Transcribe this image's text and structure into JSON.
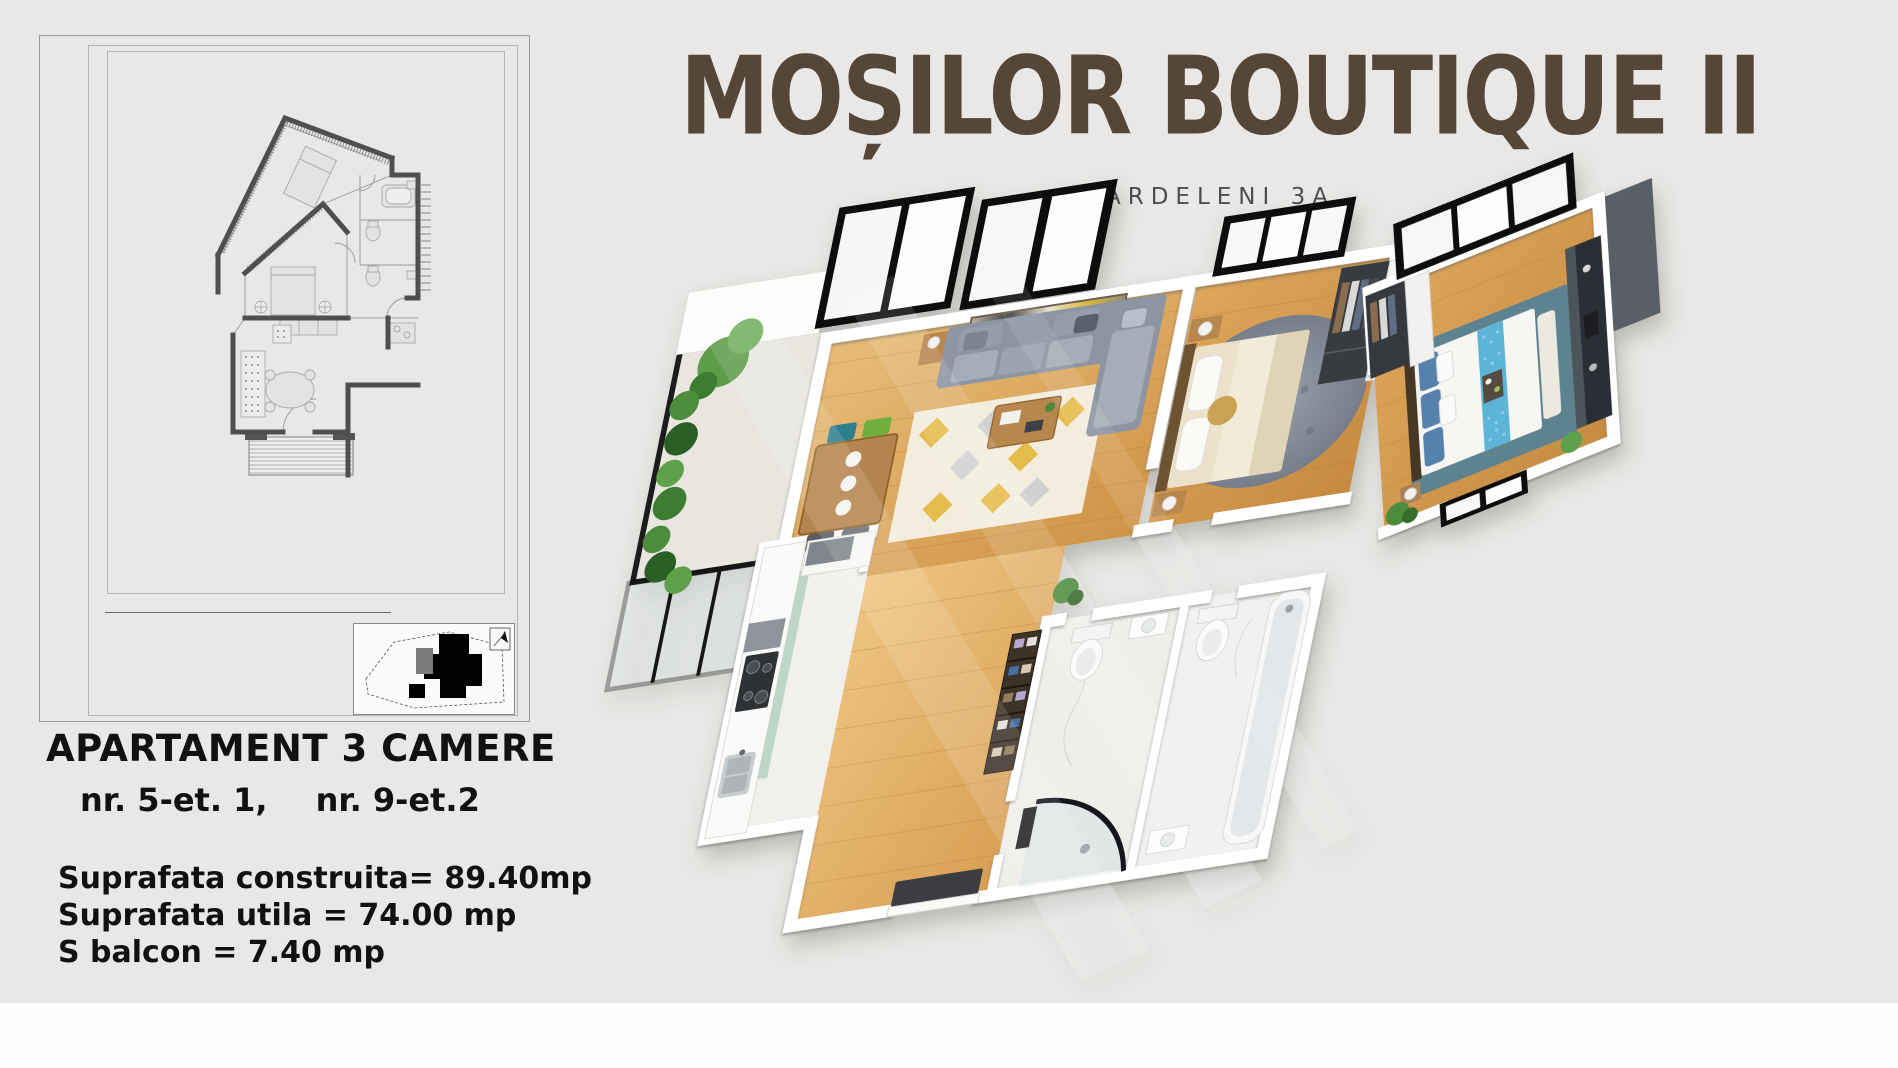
{
  "project": {
    "title": "MOȘILOR BOUTIQUE II",
    "subtitle": "ARDELENI 3A",
    "title_color": "#554637"
  },
  "apartment": {
    "title": "APARTAMENT 3 CAMERE",
    "unit_left": "nr. 5-et. 1,",
    "unit_right": "nr. 9-et.2",
    "areas": [
      "Suprafata construita= 89.40mp",
      "Suprafata utila = 74.00 mp",
      "S balcon = 7.40 mp"
    ]
  },
  "site_plan": {
    "north_icon": "north-arrow"
  },
  "palette": {
    "canvas_bg": "#e9e8e6",
    "footer_bg": "#fdfdfc",
    "text_black": "#111111",
    "title_brown": "#554637",
    "subtitle_gray": "#4e4e4e",
    "plan_wall_gray": "#4f4f4f",
    "wood_floor": "#dda75e",
    "wall_white": "#ffffff",
    "window_black": "#131313",
    "sofa_gray": "#9aa1ad",
    "rug_yellow": "#e4b63c",
    "rug_teal": "#5d8290",
    "bed_blue": "#5cb5d6",
    "plant_green": "#4e8c3e",
    "marble_white": "#f1f0ed"
  }
}
